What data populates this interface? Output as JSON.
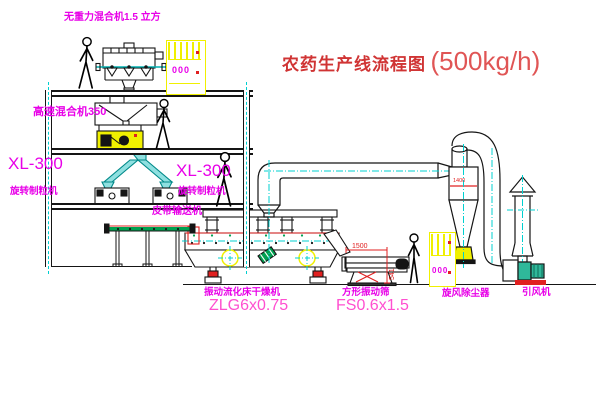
{
  "title": {
    "text": "农药生产线流程图",
    "capacity": "(500kg/h)"
  },
  "labels": {
    "top_mixer": "无重力混合机1.5 立方",
    "highspeed_mixer": "高速混合机350",
    "xl300_left": "XL-300",
    "granulator_left": "旋转制粒机",
    "xl300_right": "XL-300",
    "granulator_right": "旋转制粒机",
    "belt_conveyor": "皮带输送机",
    "dryer_name": "振动流化床干燥机",
    "dryer_model": "ZLG6x0.75",
    "screen_name": "方形振动筛",
    "screen_model": "FS0.6x1.5",
    "cyclone": "旋风除尘器",
    "fan": "引风机"
  },
  "dimensions": {
    "screen_length": "1500",
    "screen_height": "541",
    "cyclone_note": "1400"
  },
  "cabinets": {
    "cabinet1_display": "000",
    "cabinet2_display": "000"
  },
  "icons": [
    "person-icon",
    "crosshair-centerline-icon"
  ],
  "colors": {
    "label_magenta": "#e800e8",
    "model_pink": "#ff4fd0",
    "title_red": "#d03434",
    "capacity_red": "#e05555",
    "centerline_cyan": "#00d0d0",
    "highlight_yellow": "#f0f000",
    "machine_green": "#00a050",
    "detail_red": "#e02020",
    "line_black": "#151515"
  }
}
